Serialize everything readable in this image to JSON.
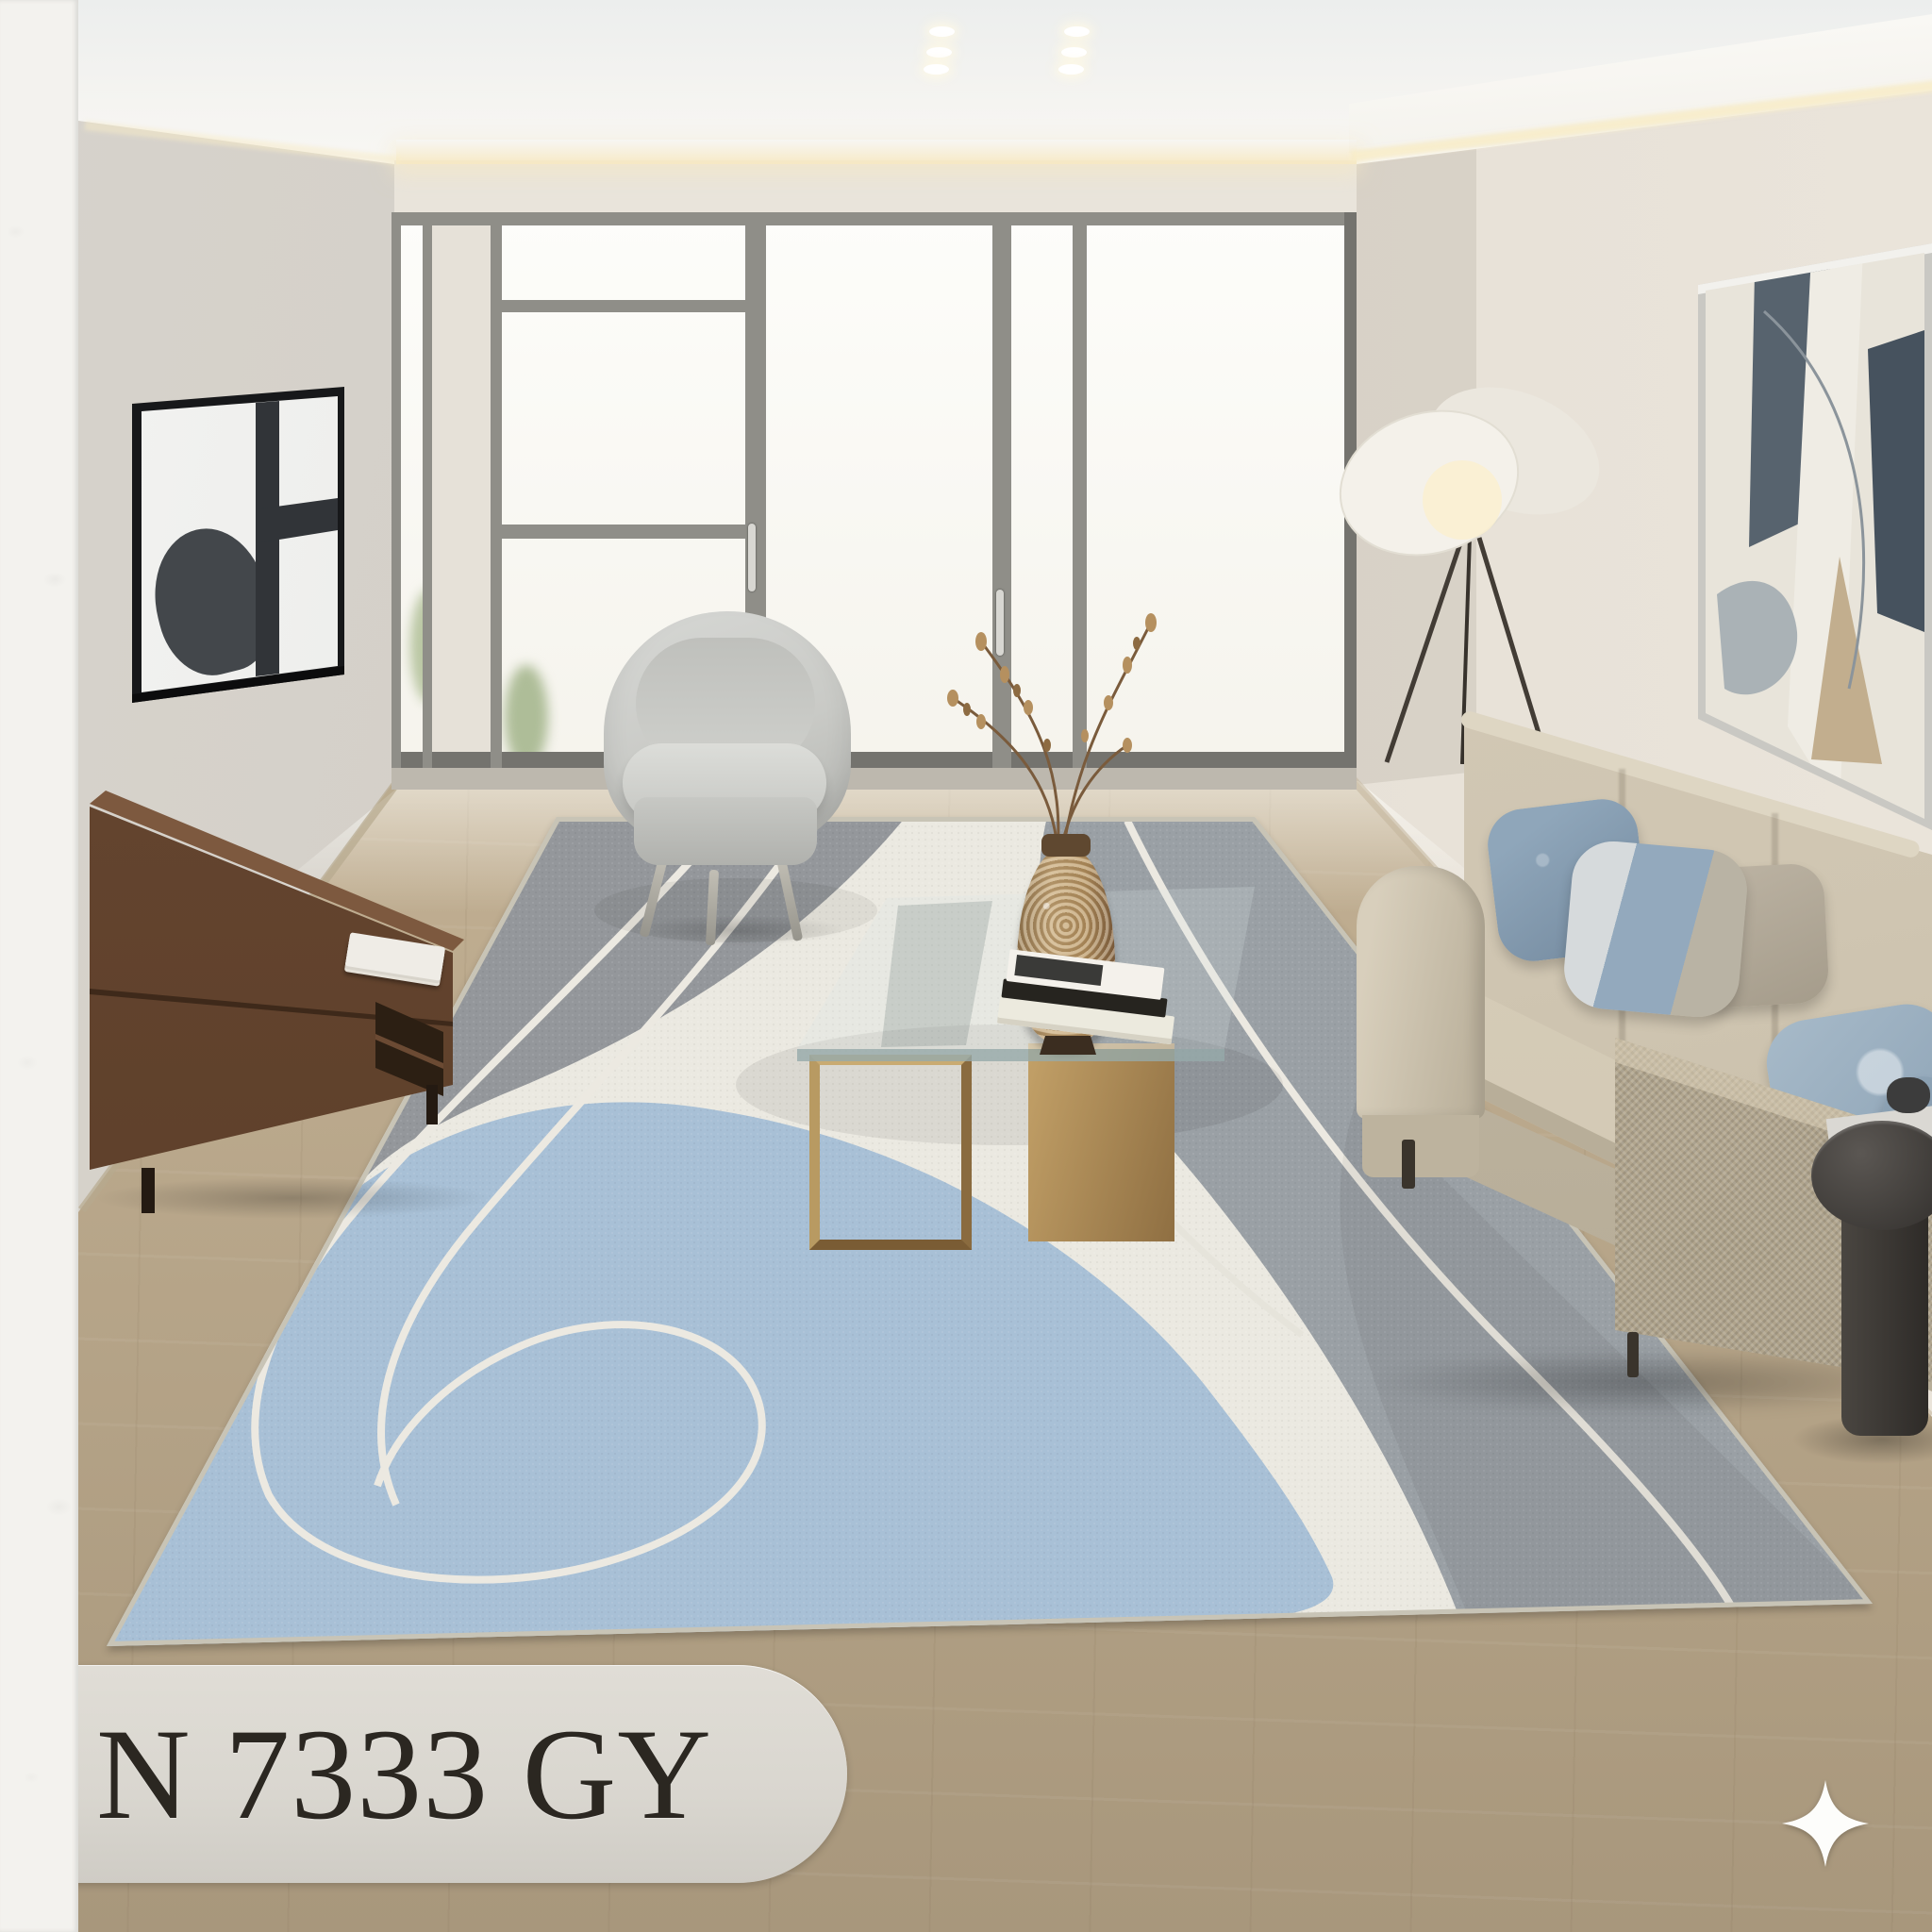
{
  "product_label": {
    "code": "N 7333 GY"
  },
  "badge": {
    "icon": "sparkle-icon"
  },
  "palette": {
    "left_strip": "#f3f2ee",
    "plaque_bg": "#d9d6cf",
    "plaque_text": "#2b2721",
    "wall_left": "#d7d3cc",
    "wall_right": "#e4ded5",
    "window_frame": "#8f8e88",
    "floor_light": "#d3c5a9",
    "floor_dark": "#a8977c",
    "rug_grey": "#94979b",
    "rug_band_grey": "#9aa0a5",
    "rug_cream": "#ebe9e1",
    "rug_blue": "#a8c0d6",
    "rug_line": "#ece9e1",
    "sofa_beige": "#cfc5b1",
    "pillow_blue": "#8fa6ba",
    "wood_walnut": "#6b4a33",
    "table_bronze": "#c3a168",
    "armchair_grey": "#c9cac6",
    "lamp_shade": "#f3f0e9",
    "side_table": "#3b3835",
    "sparkle": "#fdfdfb"
  }
}
